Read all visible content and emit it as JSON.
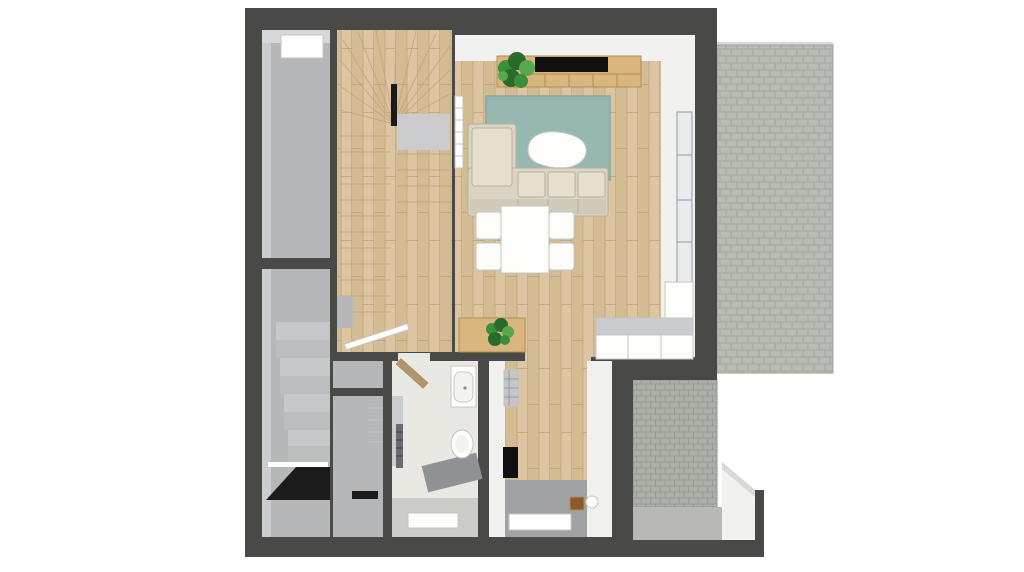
{
  "scene": {
    "kind": "top-down 3D floor plan rendering",
    "background": "#ffffff",
    "rooms": [
      {
        "name": "left-corridor-upper",
        "floor": "gray-concrete",
        "features": [
          "skylight"
        ]
      },
      {
        "name": "left-corridor-lower",
        "floor": "gray-concrete",
        "features": [
          "descending-stairs",
          "dark-doorway"
        ]
      },
      {
        "name": "staircase-hall",
        "floor": "wood",
        "features": [
          "winder-staircase",
          "landing",
          "handrail"
        ]
      },
      {
        "name": "living-dining-room",
        "floor": "wood"
      },
      {
        "name": "bathroom",
        "floor": "light-tile"
      },
      {
        "name": "storage-closet",
        "floor": "gray"
      },
      {
        "name": "kitchen-passage",
        "floor": "wood-and-gray-tile"
      },
      {
        "name": "terrace",
        "floor": "light-gray-pavers"
      },
      {
        "name": "patio",
        "floor": "gray-pavers-and-concrete"
      }
    ],
    "furniture": [
      {
        "name": "tv-sideboard"
      },
      {
        "name": "tv"
      },
      {
        "name": "monstera-plant-large"
      },
      {
        "name": "wall-radiator"
      },
      {
        "name": "area-rug"
      },
      {
        "name": "coffee-table"
      },
      {
        "name": "corner-sofa"
      },
      {
        "name": "dining-table"
      },
      {
        "name": "dining-chair",
        "count": 4
      },
      {
        "name": "sideboard-with-plant"
      },
      {
        "name": "kitchen-counter"
      },
      {
        "name": "kitchen-tall-cabinet"
      },
      {
        "name": "glass-terrace-door"
      },
      {
        "name": "bathroom-door-open"
      },
      {
        "name": "washbasin"
      },
      {
        "name": "toilet"
      },
      {
        "name": "towel-radiator"
      },
      {
        "name": "shower-area"
      },
      {
        "name": "bath-mat"
      },
      {
        "name": "kitchenette-sink"
      },
      {
        "name": "cooktop"
      },
      {
        "name": "wooden-stool"
      },
      {
        "name": "waste-bin"
      },
      {
        "name": "doormat"
      }
    ]
  },
  "palette": {
    "wall": "#494948",
    "dark": "#1b1b1b",
    "white": "#fdfdfc",
    "porcelain": "#f3f3f0",
    "floorGray": "#b6b7b9",
    "wallFaceGray": "#cbccce",
    "wallFaceGrayLight": "#d7d8d9",
    "wallFaceWhite": "#f1f1ef",
    "stepA": "#c6c7c9",
    "stepB": "#bcbdbf",
    "woodBase": "#dcc5a0",
    "woodShade": "#d3bb94",
    "woodLine": "#bfa379",
    "paverBaseLight": "#b7bcb4",
    "paverLineLight": "#9da49b",
    "paverBaseDark": "#abb1a8",
    "paverLineDark": "#8f968c",
    "pavingEdge": "#d9dad7",
    "concrete": "#b8b9b7",
    "rug": "#97b8b0",
    "rugLine": "#85a89f",
    "sofa": "#dad4c4",
    "sofaCushion": "#e5dfcf",
    "sofaBack": "#d0cab9",
    "sofaLine": "#b7b09d",
    "consoleWood": "#d9b67e",
    "consoleLine": "#b08e55",
    "tv": "#101010",
    "glass": "#e9ebed",
    "glassFrame": "#9099a0",
    "plantDark": "#2a6b2a",
    "plantMid": "#3c8f39",
    "plantLight": "#55a84e",
    "doorWood": "#ae9872",
    "bathFloor": "#eae8e2",
    "bathGray": "#cbcbca",
    "shower": "#909193",
    "kitchenGray": "#a0a2a4",
    "steel": "#c3c5c7",
    "counterTop": "#c9cbcd",
    "radiator": "#6b6b6d",
    "stool": "#8a5a2e",
    "lineLight": "#c6c6c6"
  }
}
